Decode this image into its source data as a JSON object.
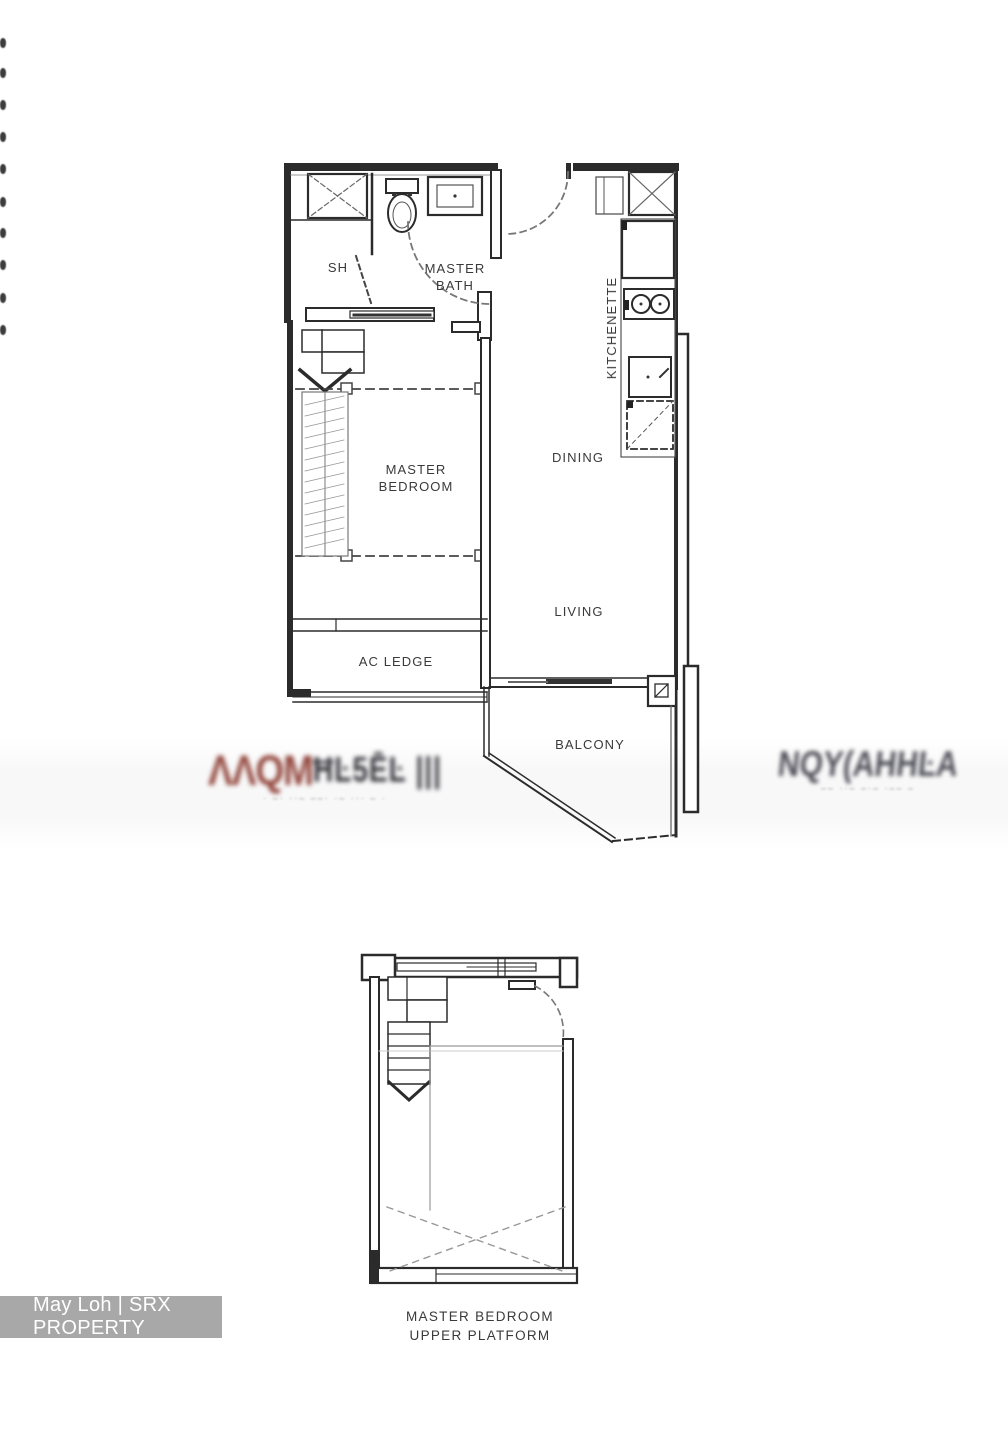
{
  "credit_bar": {
    "text": "May Loh | SRX PROPERTY",
    "bg": "#a8a8a8"
  },
  "upper_plan": {
    "labels": {
      "sh": "SH",
      "master_bath_1": "MASTER",
      "master_bath_2": "BATH",
      "kitchenette": "KITCHENETTE",
      "master_bedroom_1": "MASTER",
      "master_bedroom_2": "BEDROOM",
      "dining": "DINING",
      "living": "LIVING",
      "ac_ledge": "AC LEDGE",
      "balcony": "BALCONY"
    }
  },
  "lower_plan": {
    "labels": {
      "line1": "MASTER BEDROOM",
      "line2": "UPPER PLATFORM"
    }
  },
  "watermarks": {
    "left_red": "ΛΛQM",
    "left_dark": "ĦĿ5ĒĿ |||",
    "left_sub": "· –· ··– ––· ·– ··· – ·",
    "right_main": "NQY(AHHĿA",
    "right_sub": "–– ··– –·– ·–– –"
  },
  "colors": {
    "line": "#2b2b2b",
    "label": "#3a3a3a",
    "watermark_red": "#93473e",
    "watermark_gray": "#4e4e58"
  }
}
